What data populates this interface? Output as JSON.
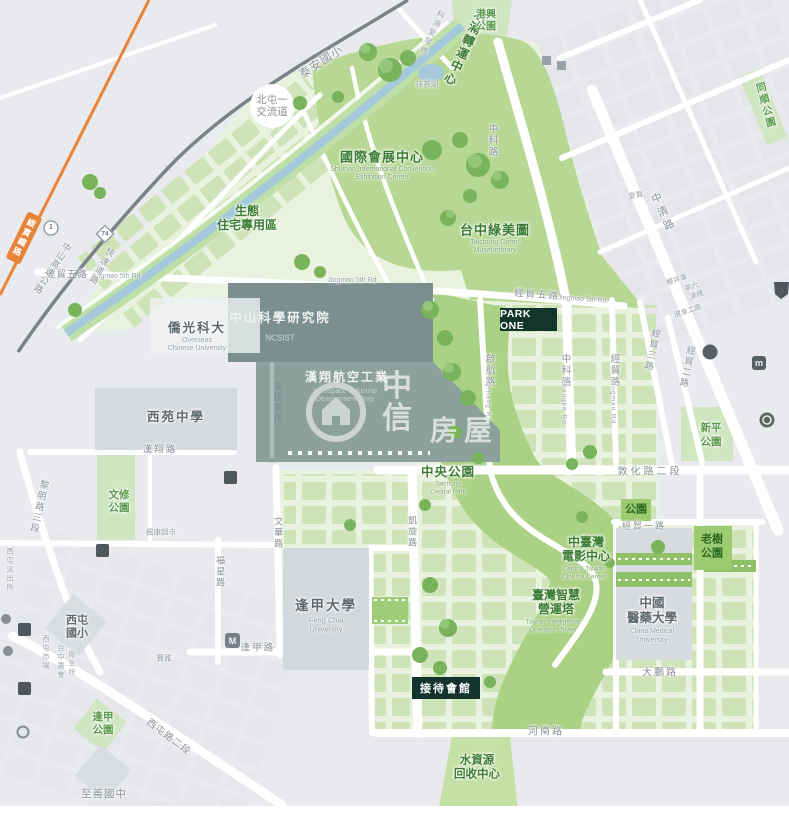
{
  "watermark": {
    "c1": "中",
    "c2": "信",
    "c3": "房屋"
  },
  "badges": {
    "park_one": "PARK ONE",
    "reception": "接待會館"
  },
  "facilities": {
    "convention_zh": "國際會展中心",
    "convention_en1": "Shuinan International Convention",
    "convention_en2": "Exhibition Center",
    "museumbrary_zh": "台中綠美圖",
    "museumbrary_en1": "Taichung Green",
    "museumbrary_en2": "Museumbrary",
    "transit_center": "水湳轉運中心",
    "eco1": "生態",
    "eco2": "住宅專用區",
    "ncsist_zh": "中山科學研究院",
    "ncsist_en": "NCSIST",
    "aidc_zh": "漢翔航空工業",
    "aidc_en1": "Aerospace Industrial",
    "aidc_en2": "Development Corp",
    "ocu_zh": "僑光科大",
    "ocu_en1": "Overseas",
    "ocu_en2": "Chinese University",
    "xiyuan": "西苑中學",
    "central_park_zh": "中央公園",
    "central_park_en1": "Taichung",
    "central_park_en2": "Central Park",
    "fcu_zh": "逢甲大學",
    "fcu_en1": "Feng Chia",
    "fcu_en2": "University",
    "cmu_zh1": "中國",
    "cmu_zh2": "醫藥大學",
    "cmu_en1": "China Medical",
    "cmu_en2": "University",
    "cinema_zh1": "中臺灣",
    "cinema_zh2": "電影中心",
    "cinema_en1": "Central Taiwan",
    "cinema_en2": "Cinema Center",
    "tower_zh1": "臺灣智慧",
    "tower_zh2": "營運塔",
    "tower_en1": "Taiwan Intelligence",
    "tower_en2": "Operation Tower",
    "wrc1": "水資源",
    "wrc2": "回收中心",
    "taian": "泰安國小",
    "interchange1": "北屯一",
    "interchange2": "交流道",
    "xitun_es1": "西屯",
    "xitun_es2": "國小",
    "zhishan": "至善國中"
  },
  "parks": {
    "gangxing1": "港興",
    "gangxing2": "公園",
    "tongrong": "同順公園",
    "xinping1": "新平",
    "xinping2": "公園",
    "wenxiu1": "文修",
    "wenxiu2": "公園",
    "fengjia1": "逢甲",
    "fengjia2": "公園",
    "laoshu1": "老樹",
    "laoshu2": "公園",
    "park_badge": "公園",
    "matcha_lake": "抹茶湖"
  },
  "roads": {
    "jingmao5_l": "經貿五路",
    "jingmao5_l_en": "Jingmao 5th Rd",
    "jingmao5_m_en": "Jingmao 5th Rd",
    "jingmao5_r": "經貿五路",
    "jingmao5_r_en": "Jingmao 5th Rd.",
    "qihang": "啟航路",
    "qihang_en": "Qihang Rd",
    "zhongke_n": "中科路",
    "zhongke_s": "中科路",
    "zhongke_en": "Zhongke Rd",
    "jingmao_rd": "經貿路",
    "jingmao_rd_en": "Jingmao Rd",
    "jingmao3": "經貿三路",
    "jingmao2": "經貿二路",
    "jingmao1": "經貿一路",
    "dunhua2": "敦化路二段",
    "dapeng": "大鵬路",
    "henan": "河南路",
    "kaixuan": "凱旋路",
    "wenhua": "文華路",
    "fuxing": "福星路",
    "hanxiang": "漢翔路",
    "hanxiang_e": "漢翔東路",
    "fengjia_rd": "逢甲路",
    "liming3": "黎明路三段",
    "xitun2": "西屯路二段",
    "zhongqing": "中清路",
    "freeway": "中山高速公路",
    "freeway_no": "1",
    "expressway": "快速道路",
    "expressway_no": "74",
    "railway": "縱貫鐵路",
    "bridge": "科湳愛琴橋"
  },
  "pois": {
    "aimai": "愛買",
    "karuizawa": "輕井澤",
    "cha_liu": "茶六",
    "tang_zhan": "湯棧",
    "fitness_factory": "健身工廠",
    "fengkang_market": "楓康超市",
    "xitun_market": "西屯市場",
    "farmers_assoc": "台中農會",
    "health_station": "衛生所",
    "police_station": "西屯派出所",
    "poya": "寶雅"
  },
  "icons": {
    "mcdonalds_m": "M",
    "m_square": "m"
  },
  "colors": {
    "accent_dark_green": "#12352c",
    "park_green": "#b7d794",
    "water": "#a3c9db",
    "railway_orange": "#e8833a"
  }
}
